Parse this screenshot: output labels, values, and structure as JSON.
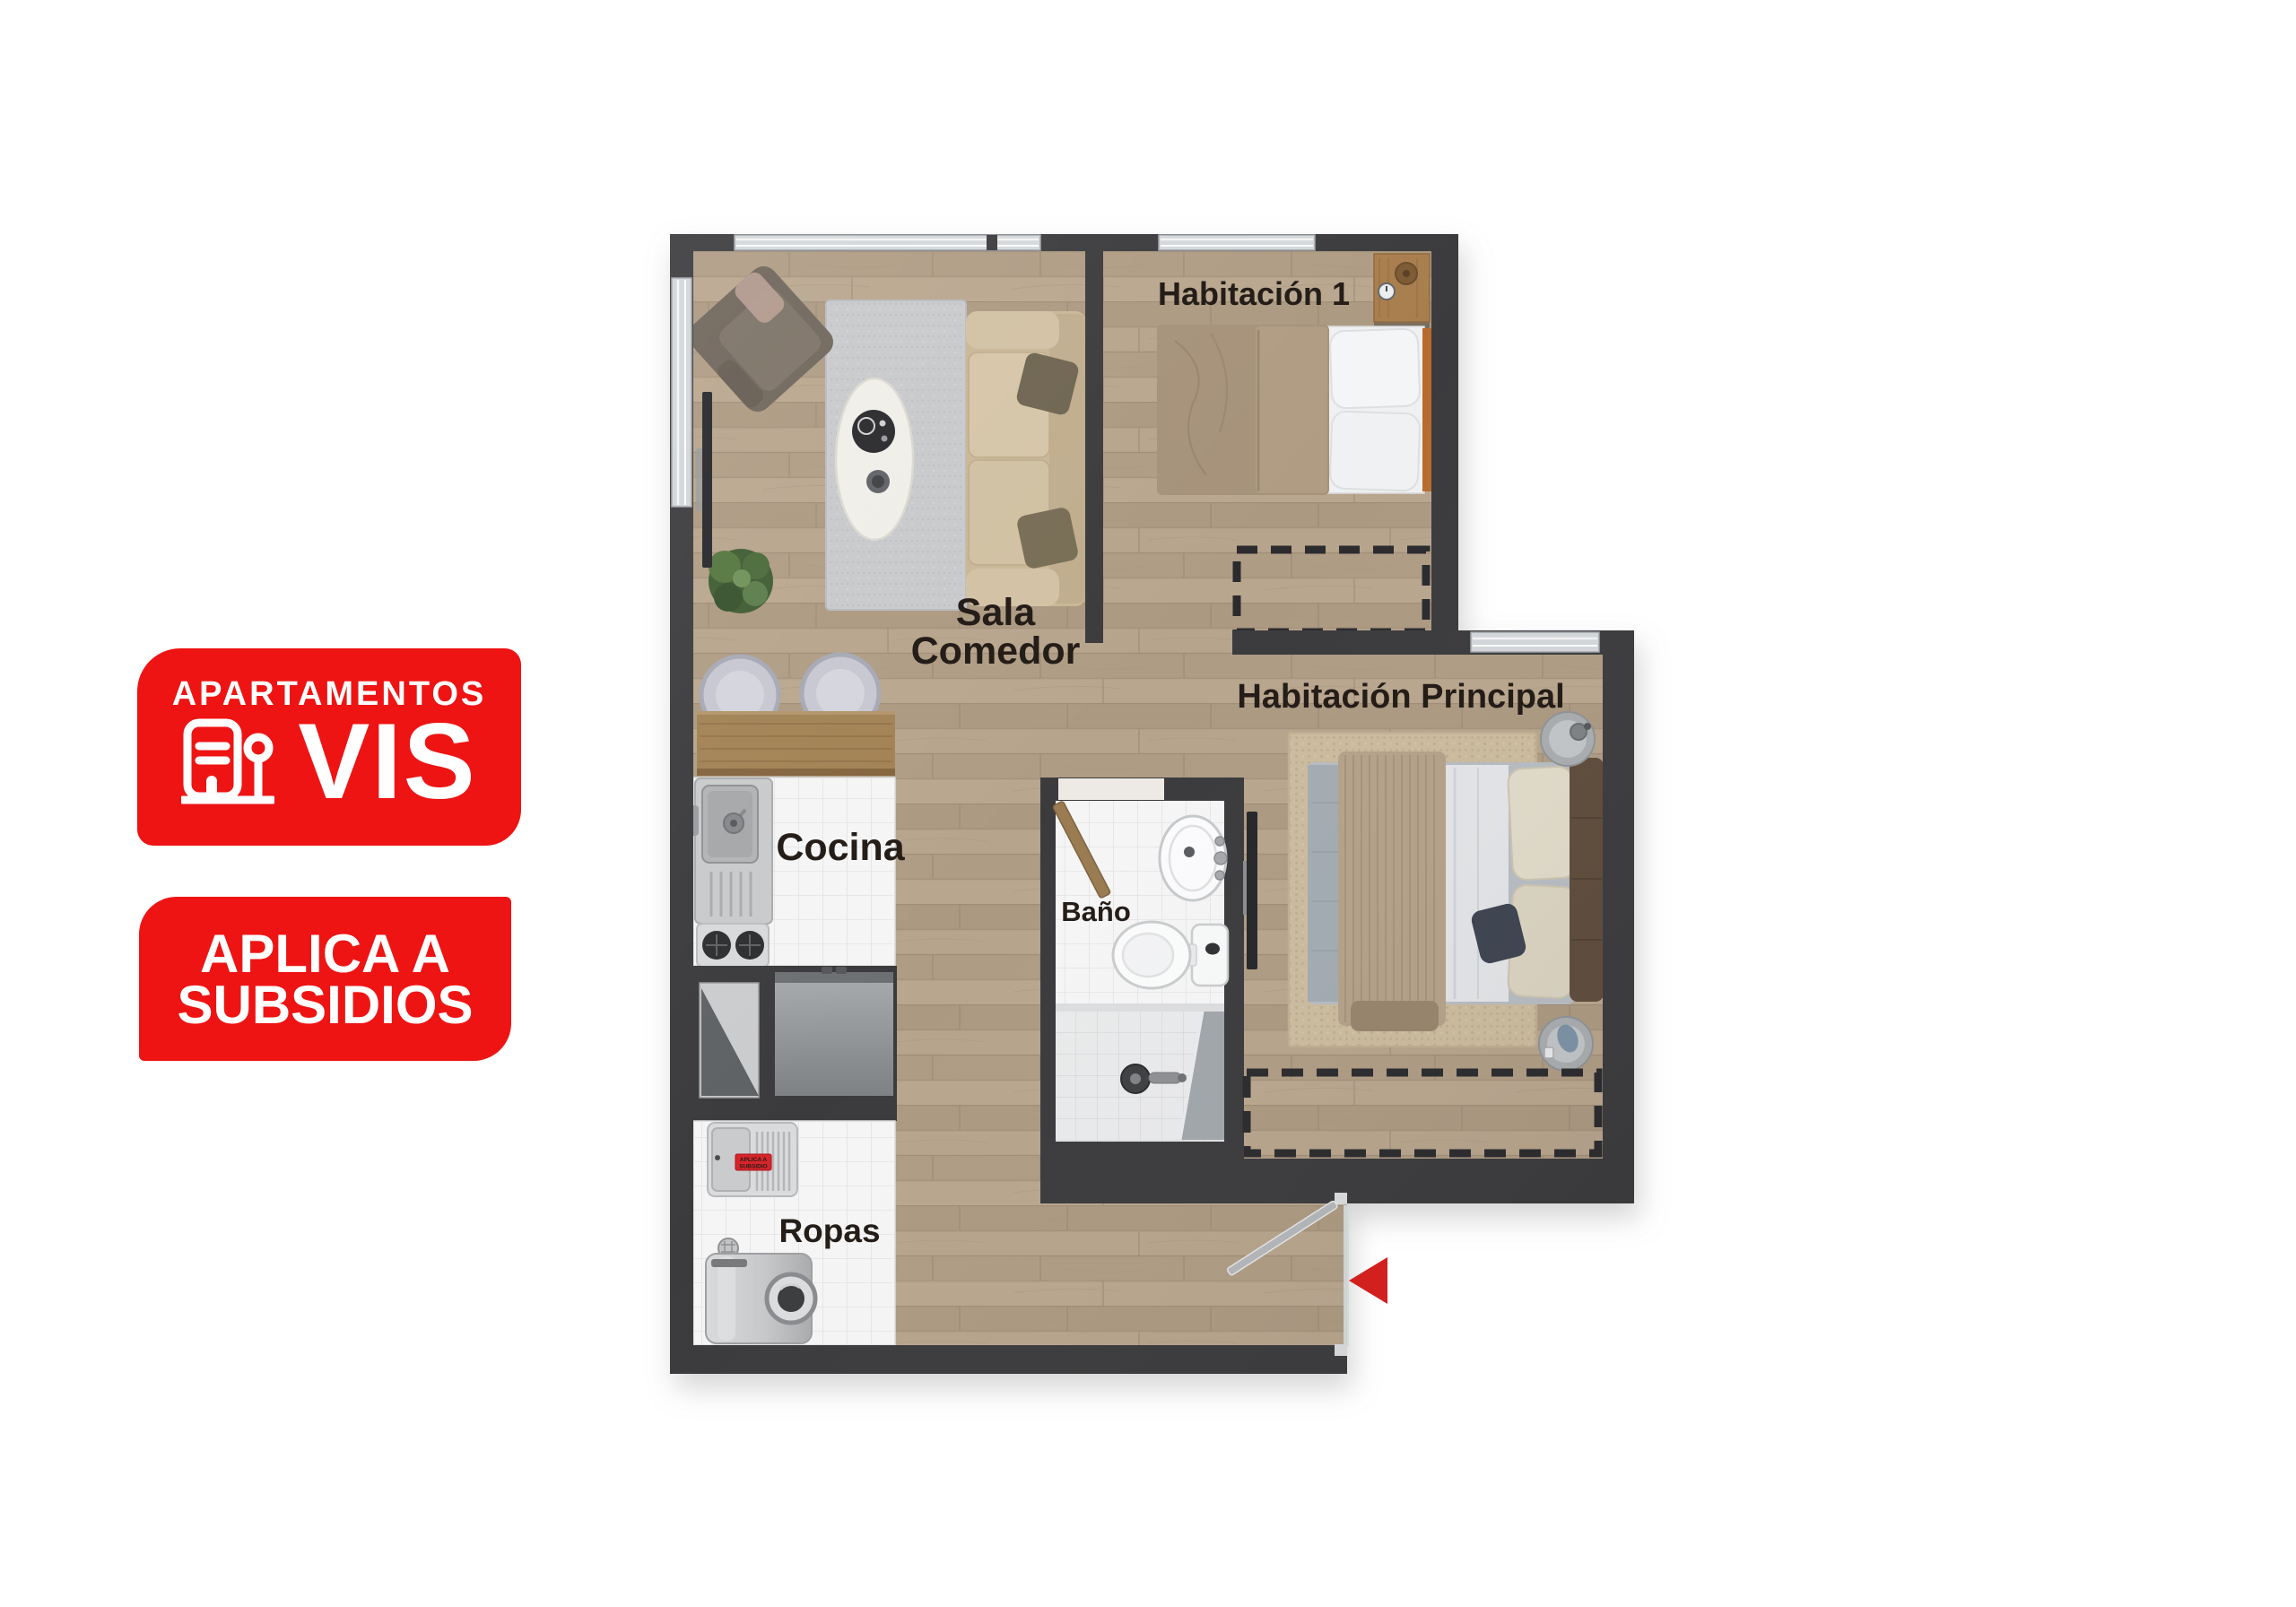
{
  "badges": {
    "vis": {
      "top_label": "APARTAMENTOS",
      "big_label": "VIS",
      "icon": "apartment-building-icon",
      "bg_color": "#EE1414",
      "text_color": "#FFFFFF"
    },
    "subsidios": {
      "line1": "APLICA A",
      "line2": "SUBSIDIOS",
      "bg_color": "#EE1414",
      "text_color": "#FFFFFF"
    }
  },
  "floorplan": {
    "rooms": {
      "bedroom1": {
        "label": "Habitación 1"
      },
      "master": {
        "label": "Habitación Principal"
      },
      "living": {
        "label_line1": "Sala",
        "label_line2": "Comedor"
      },
      "kitchen": {
        "label": "Cocina"
      },
      "bathroom": {
        "label": "Baño"
      },
      "laundry": {
        "label": "Ropas",
        "tag_line1": "APLICA A",
        "tag_line2": "SUBSIDIO"
      }
    },
    "entry_arrow": {
      "direction": "left",
      "color": "#D2201F"
    },
    "colors": {
      "wall": "#3B3B3D",
      "wood_floor": "#B3A089",
      "tile": "#F5F5F5",
      "label_text": "#241D18",
      "accent_red": "#EE1414"
    }
  }
}
